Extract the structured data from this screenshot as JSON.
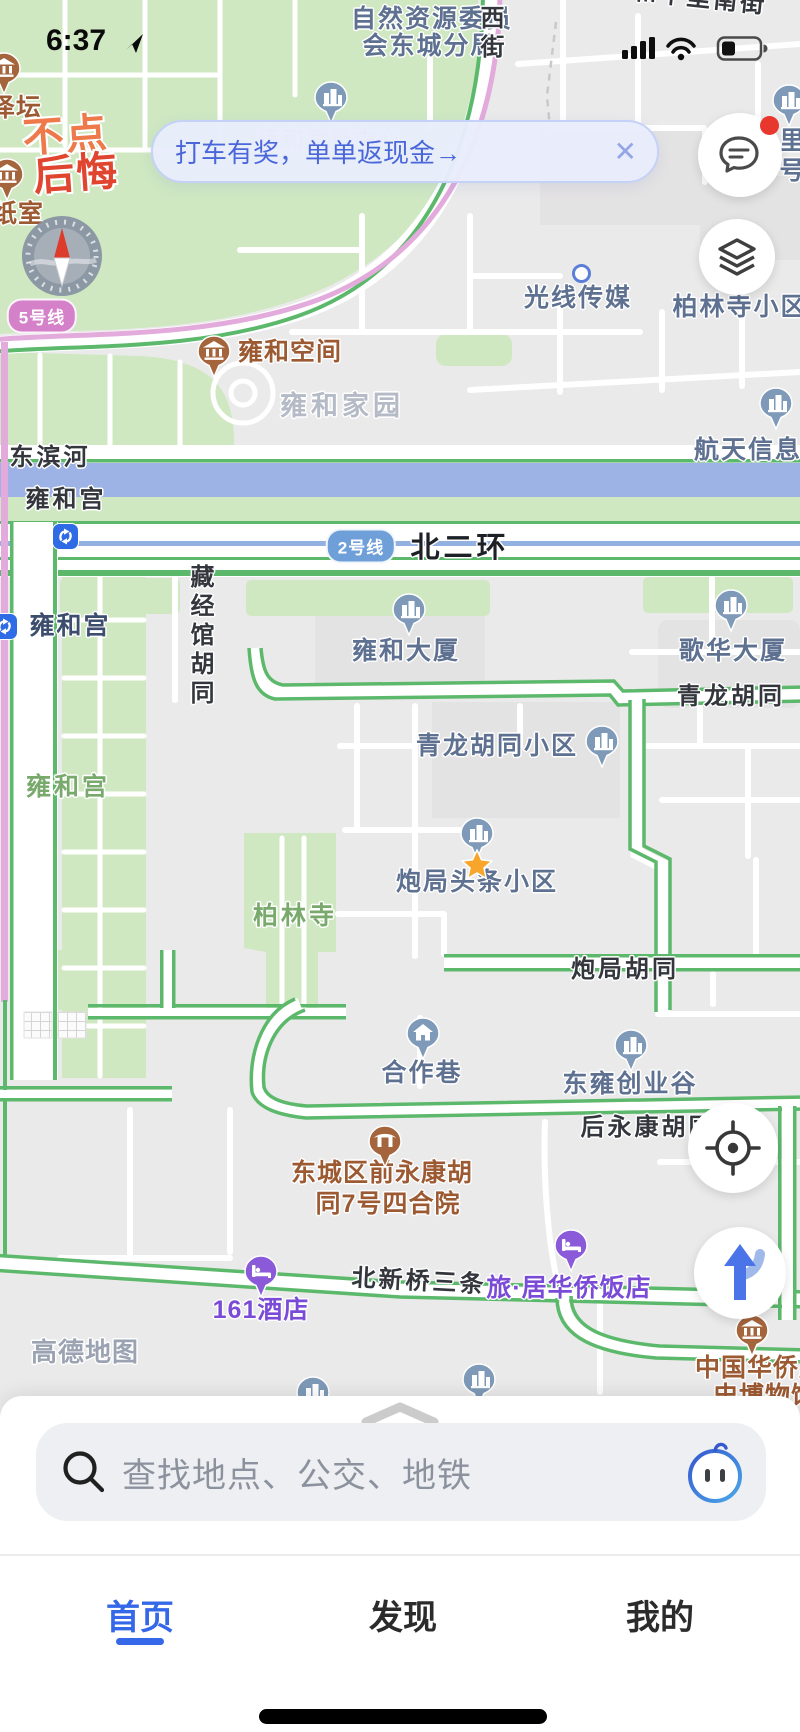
{
  "status": {
    "time": "6:37"
  },
  "banner": {
    "text": "打车有奖，单单返现金→",
    "close": "✕"
  },
  "ad": {
    "line1": "不点",
    "line2": "后悔"
  },
  "icons": [
    "location-arrow-icon",
    "signal-icon",
    "wifi-icon",
    "battery-icon",
    "chat-bubble-icon",
    "layers-icon",
    "compass-icon",
    "crosshair-locate-icon",
    "route-arrow-icon",
    "magnifier-icon",
    "assistant-mascot-icon",
    "chevron-up-icon",
    "close-icon",
    "metro-transfer-icon",
    "favorite-star-icon"
  ],
  "palette": {
    "accent_blue": "#3568e8",
    "banner_blue": "#4a67d9",
    "metro5_pink": "#d581c9",
    "metro2_blue": "#6f9fd8",
    "road_green": "#5cb96c",
    "park_green": "#cfe8c2",
    "river_blue": "#9db3e6",
    "poi_slate": "#5e7191",
    "poi_brown": "#9c5a33",
    "poi_purple": "#7a4bd6",
    "star_orange": "#f7a62b",
    "badge_red": "#e8382e"
  },
  "map": {
    "labels": [
      {
        "t": "自然资源委员",
        "x": 432,
        "y": 6,
        "k": "poi"
      },
      {
        "t": "会东城分局",
        "x": 430,
        "y": 33,
        "k": "poi"
      },
      {
        "t": "西街",
        "x": 489,
        "y": 5,
        "k": "road",
        "vert": 1
      },
      {
        "t": "和平里南街",
        "x": 700,
        "y": -14,
        "k": "road",
        "rot": 6
      },
      {
        "t": "里",
        "x": 793,
        "y": 128,
        "k": "poi"
      },
      {
        "t": "号",
        "x": 793,
        "y": 158,
        "k": "poi"
      },
      {
        "t": "泽坛",
        "x": 16,
        "y": 95,
        "k": "brown"
      },
      {
        "t": "纸室",
        "x": 18,
        "y": 201,
        "k": "brown"
      },
      {
        "t": "雍和宫壹中心",
        "x": 330,
        "y": 128,
        "k": "area2"
      },
      {
        "t": "柏林寺小区",
        "x": 740,
        "y": 294,
        "k": "poi"
      },
      {
        "t": "光线传媒",
        "x": 578,
        "y": 285,
        "k": "poi"
      },
      {
        "t": "雍和空间",
        "x": 290,
        "y": 339,
        "k": "brown"
      },
      {
        "t": "雍和家园",
        "x": 342,
        "y": 392,
        "k": "area"
      },
      {
        "t": "航天信息",
        "x": 748,
        "y": 437,
        "k": "poi"
      },
      {
        "t": "东滨河",
        "x": 50,
        "y": 445,
        "k": "road"
      },
      {
        "t": "雍和宫",
        "x": 66,
        "y": 487,
        "k": "road"
      },
      {
        "t": "北二环",
        "x": 460,
        "y": 533,
        "k": "roadbold"
      },
      {
        "t": "雍和宫",
        "x": 70,
        "y": 613,
        "k": "station"
      },
      {
        "t": "藏经馆胡同",
        "x": 199,
        "y": 564,
        "k": "road",
        "vert": 1
      },
      {
        "t": "雍和大厦",
        "x": 406,
        "y": 638,
        "k": "poi"
      },
      {
        "t": "歌华大厦",
        "x": 733,
        "y": 638,
        "k": "poi"
      },
      {
        "t": "青龙胡同",
        "x": 731,
        "y": 684,
        "k": "road"
      },
      {
        "t": "青龙胡同小区",
        "x": 497,
        "y": 733,
        "k": "poi"
      },
      {
        "t": "雍和宫",
        "x": 68,
        "y": 774,
        "k": "areagreen"
      },
      {
        "t": "炮局头条小区",
        "x": 477,
        "y": 869,
        "k": "poi"
      },
      {
        "t": "柏林寺",
        "x": 295,
        "y": 903,
        "k": "areagreen"
      },
      {
        "t": "炮局胡同",
        "x": 625,
        "y": 957,
        "k": "road"
      },
      {
        "t": "合作巷",
        "x": 422,
        "y": 1060,
        "k": "poi"
      },
      {
        "t": "东雍创业谷",
        "x": 630,
        "y": 1071,
        "k": "poi"
      },
      {
        "t": "后永康胡同",
        "x": 648,
        "y": 1115,
        "k": "road"
      },
      {
        "t": "东城区前永康胡",
        "x": 382,
        "y": 1160,
        "k": "brown"
      },
      {
        "t": "同7号四合院",
        "x": 388,
        "y": 1191,
        "k": "brown"
      },
      {
        "t": "北新桥三条",
        "x": 419,
        "y": 1269,
        "k": "road",
        "rot": 3
      },
      {
        "t": "旅·居华侨饭店",
        "x": 569,
        "y": 1275,
        "k": "purple"
      },
      {
        "t": "161酒店",
        "x": 261,
        "y": 1297,
        "k": "purple"
      },
      {
        "t": "高德地图",
        "x": 85,
        "y": 1338,
        "k": "watermark"
      },
      {
        "t": "中国华侨历",
        "x": 760,
        "y": 1355,
        "k": "brown"
      },
      {
        "t": "史博物馆",
        "x": 765,
        "y": 1383,
        "k": "brown"
      }
    ],
    "pins": [
      {
        "x": 331,
        "y": 97,
        "c": "blue",
        "g": "building"
      },
      {
        "x": 789,
        "y": 100,
        "c": "blue",
        "g": "building"
      },
      {
        "x": 776,
        "y": 403,
        "c": "blue",
        "g": "building"
      },
      {
        "x": 214,
        "y": 351,
        "c": "brown",
        "g": "museum"
      },
      {
        "x": 4,
        "y": 68,
        "c": "brown",
        "g": "museum"
      },
      {
        "x": 7,
        "y": 174,
        "c": "brown",
        "g": "museum"
      },
      {
        "x": 409,
        "y": 609,
        "c": "blue",
        "g": "building"
      },
      {
        "x": 731,
        "y": 605,
        "c": "blue",
        "g": "building"
      },
      {
        "x": 602,
        "y": 741,
        "c": "blue",
        "g": "building"
      },
      {
        "x": 477,
        "y": 833,
        "c": "blue",
        "g": "building"
      },
      {
        "x": 423,
        "y": 1033,
        "c": "blue",
        "g": "house"
      },
      {
        "x": 631,
        "y": 1045,
        "c": "blue",
        "g": "building"
      },
      {
        "x": 385,
        "y": 1141,
        "c": "brown",
        "g": "gate"
      },
      {
        "x": 752,
        "y": 1330,
        "c": "brown",
        "g": "museum"
      },
      {
        "x": 261,
        "y": 1271,
        "c": "purple",
        "g": "bed"
      },
      {
        "x": 571,
        "y": 1245,
        "c": "purple",
        "g": "bed"
      },
      {
        "x": 479,
        "y": 1379,
        "c": "blue",
        "g": "building"
      },
      {
        "x": 313,
        "y": 1392,
        "c": "blue",
        "g": "building"
      }
    ],
    "badges": [
      {
        "t": "5号线",
        "x": 42,
        "y": 316,
        "c": "pink"
      },
      {
        "t": "2号线",
        "x": 361,
        "y": 546,
        "c": "blue"
      }
    ],
    "transfers": [
      {
        "x": 65,
        "y": 536
      },
      {
        "x": 4,
        "y": 626
      }
    ],
    "star": {
      "x": 477,
      "y": 864
    },
    "gps_dot": {
      "x": 580,
      "y": 272
    }
  },
  "search": {
    "placeholder": "查找地点、公交、地铁"
  },
  "tabbar": {
    "items": [
      {
        "label": "首页"
      },
      {
        "label": "发现"
      },
      {
        "label": "我的"
      }
    ],
    "active": 0
  }
}
